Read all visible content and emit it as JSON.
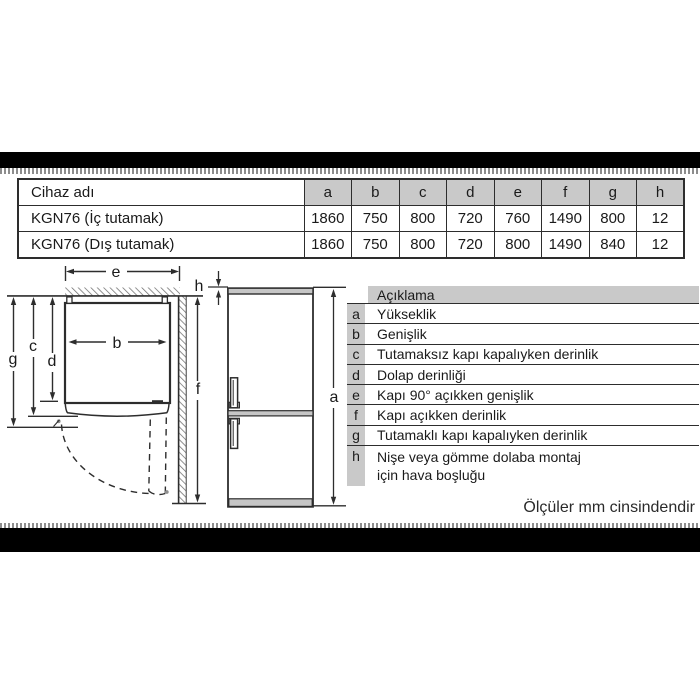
{
  "device_table": {
    "name_header": "Cihaz adı",
    "dim_headers": [
      "a",
      "b",
      "c",
      "d",
      "e",
      "f",
      "g",
      "h"
    ],
    "rows": [
      {
        "name": "KGN76 (İç tutamak)",
        "values": [
          "1860",
          "750",
          "800",
          "720",
          "760",
          "1490",
          "800",
          "12"
        ]
      },
      {
        "name": "KGN76 (Dış tutamak)",
        "values": [
          "1860",
          "750",
          "800",
          "720",
          "800",
          "1490",
          "840",
          "12"
        ]
      }
    ]
  },
  "legend": {
    "header": "Açıklama",
    "rows": [
      {
        "key": "a",
        "text": "Yükseklik"
      },
      {
        "key": "b",
        "text": "Genişlik"
      },
      {
        "key": "c",
        "text": "Tutamaksız kapı kapalıyken derinlik"
      },
      {
        "key": "d",
        "text": "Dolap derinliği"
      },
      {
        "key": "e",
        "text": "Kapı 90° açıkken genişlik"
      },
      {
        "key": "f",
        "text": "Kapı açıkken derinlik"
      },
      {
        "key": "g",
        "text": "Tutamaklı kapı kapalıyken derinlik"
      },
      {
        "key": "h",
        "text": "Nişe veya gömme dolaba montaj",
        "text2": "için hava boşluğu"
      }
    ]
  },
  "diagram": {
    "labels": {
      "e": "e",
      "h": "h",
      "g": "g",
      "c": "c",
      "d": "d",
      "b": "b",
      "f": "f",
      "a": "a"
    }
  },
  "footer": {
    "note": "Ölçüler mm cinsindendir"
  },
  "colors": {
    "table_header_gray": "#c9c9c9",
    "fridge_gray": "#c6c6c6",
    "line": "#2d2d2d",
    "bar_black": "#000000"
  }
}
